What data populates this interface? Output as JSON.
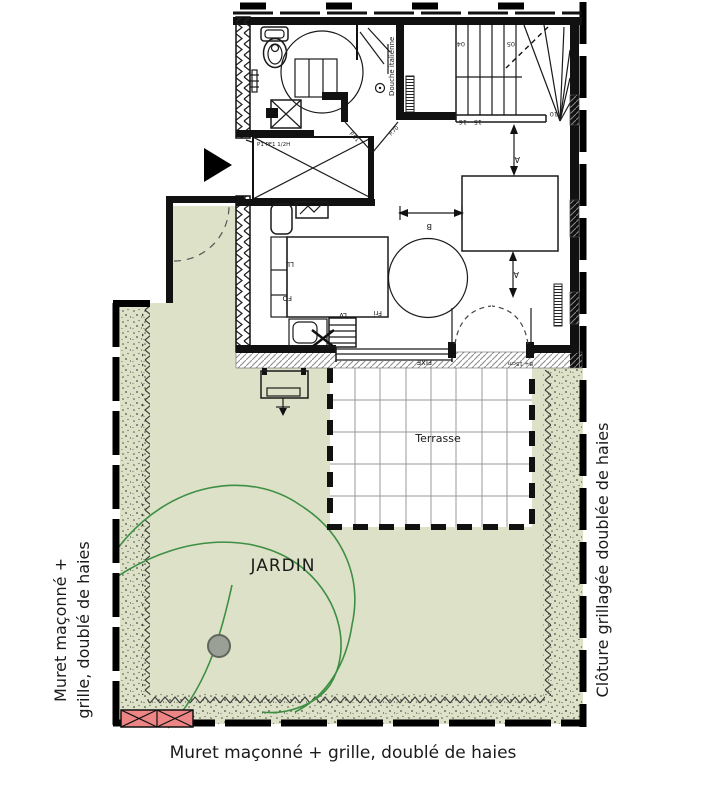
{
  "colors": {
    "garden": "#dce1c7",
    "brick": "#ed8585",
    "curve": "#3e8e44",
    "navy": "#2a3d7c",
    "ink": "#111111"
  },
  "labels": {
    "jardin": "JARDIN",
    "terrasse": "Terrasse",
    "bottom_wall": "Muret maçonné + grille, doublé de haies",
    "left_wall_line1": "Muret maçonné +",
    "left_wall_line2": "grille, doublé de haies",
    "right_fence": "Clôture grillagée doublée de haies",
    "shower": "Douche italienne"
  },
  "annotations": {
    "cupboard": "P1 PF1 1/2H",
    "door_left": "P.01",
    "door_right": "P.70",
    "window_fixed": "FIXE",
    "window_sill": "B+ 15cm",
    "dim_a": "A",
    "dim_b": "B"
  },
  "appliances": {
    "washer": "LL",
    "oven": "FO",
    "dishwasher": "LV",
    "fridge": "Fri"
  },
  "stairs": {
    "step_04": "04",
    "step_05": "05",
    "step_10": "10",
    "step_15": "15",
    "step_16": "16"
  }
}
